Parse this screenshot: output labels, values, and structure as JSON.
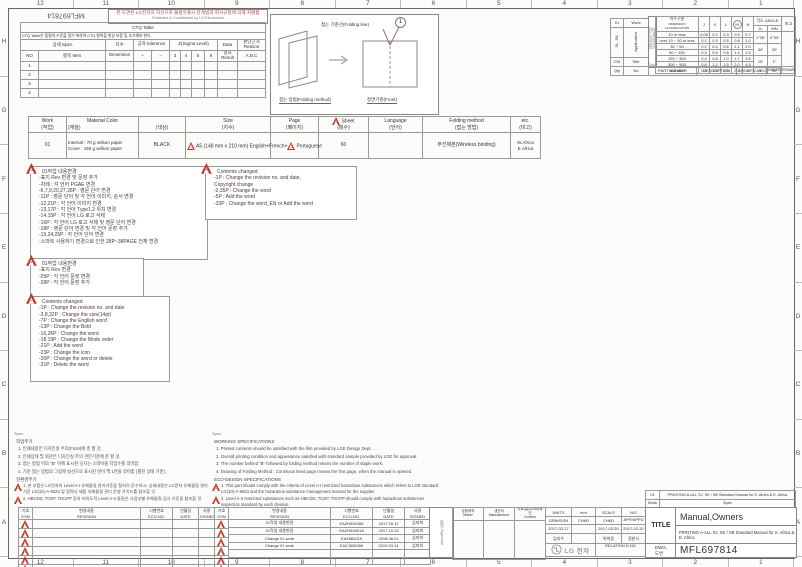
{
  "frame": {
    "ruler_top": [
      "12",
      "11",
      "10",
      "9",
      "8",
      "7",
      "6",
      "5",
      "4",
      "3",
      "2",
      "1"
    ],
    "ruler_bottom": [
      "12",
      "11",
      "10",
      "9",
      "8",
      "7",
      "6",
      "5",
      "4",
      "3",
      "2",
      "1"
    ],
    "ruler_left": [
      "H",
      "G",
      "F",
      "E",
      "D",
      "C",
      "B",
      "A"
    ],
    "ruler_right": [
      "H",
      "G",
      "F",
      "E",
      "D",
      "C",
      "B",
      "A"
    ]
  },
  "header": {
    "doc_number_flipped": "MFL697814",
    "notice_ko": "본 도면은 LG전자의 자산으로 불법유출시 관계법과 회사규정에 의해 처벌됨",
    "notice_en": "Protected & Confidential by LG Electronics"
  },
  "ctq": {
    "title": "CTQ Table",
    "note": "CTQ Table은 품질의 수준을 알기 위하여 CTQ 항목을 항상 보증 및 추가해야 한다.",
    "h_spec": "상세 Spec.",
    "h_no": "NO",
    "h_item": "항목 Item",
    "h_dim": "치수",
    "h_dim2": "Dimension",
    "h_tol": "공차 tolerance",
    "h_plus": "+",
    "h_minus": "−",
    "h_sigma": "Z(Sigma Level)",
    "sigma_levels": [
      "3",
      "4",
      "5",
      "6"
    ],
    "h_data": "Data",
    "h_result": "결과 Result",
    "h_reason": "판단근거 Reason",
    "h_abc": "A,B,C",
    "rows": [
      [
        "1",
        "",
        "",
        "",
        "",
        "",
        "",
        "",
        "",
        "",
        ""
      ],
      [
        "2",
        "",
        "",
        "",
        "",
        "",
        "",
        "",
        "",
        "",
        ""
      ],
      [
        "3",
        "",
        "",
        "",
        "",
        "",
        "",
        "",
        "",
        "",
        ""
      ],
      [
        "4",
        "",
        "",
        "",
        "",
        "",
        "",
        "",
        "",
        "",
        ""
      ]
    ]
  },
  "folding": {
    "line_label": "접는 기준선(Folding line)",
    "marker": "1",
    "method_label": "접는 방법(Folding method)",
    "front_label": "정면기준(Front)"
  },
  "app_table": {
    "rows": [
      [
        "01",
        "Work"
      ],
      [
        "SL, SK",
        "Application"
      ],
      [
        "CW",
        "Site"
      ],
      [
        "Qty",
        "No"
      ]
    ]
  },
  "part_row": [
    "PART NUMBER",
    "DESCRIPTION",
    "SPECIFICATION",
    "MAKER",
    "REMARKER"
  ],
  "tolerance": {
    "side_label": "일반공차(3급) TOLERANCE",
    "side_bottom": "2mm",
    "h_class_ko": "치수구분",
    "h_class_en": "DIMENSION CLASSIFICATION",
    "cols": [
      "J",
      "K",
      "L",
      "M",
      "N"
    ],
    "h_angle": "각도 ANGLE",
    "angle_cols": [
      "JL",
      "MN"
    ],
    "h_remark": "비고",
    "rows": [
      [
        "10 or less",
        "0.05",
        "0.2",
        "0.3",
        "0.5",
        "0.7",
        {
          "t": "1°30′",
          "rs": 2
        },
        {
          "t": "0°30′",
          "rs": 2
        },
        {
          "t": "",
          "rs": 7
        }
      ],
      [
        "over 10 ~ 30 or less",
        "0.1",
        "0.3",
        "0.5",
        "0.8",
        "1.2"
      ],
      [
        "30 ~ 50",
        "0.2",
        "0.4",
        "0.6",
        "1.1",
        "2.0",
        {
          "t": "30′",
          "rs": 2
        },
        {
          "t": "20′",
          "rs": 2
        }
      ],
      [
        "50 ~ 150",
        "0.3",
        "0.6",
        "0.8",
        "1.4",
        "2.5"
      ],
      [
        "150 ~ 300",
        "0.4",
        "0.8",
        "1.0",
        "1.7",
        "3.5",
        {
          "t": "15′",
          "rs": 2
        },
        {
          "t": "1°",
          "rs": 2
        }
      ],
      [
        "300 ~ 500",
        "0.6",
        "1.2",
        "1.5",
        "2.0",
        "4.5"
      ],
      [
        "500 over",
        "0.8",
        "1.6",
        "2.0",
        "2.5",
        "6",
        {
          "t": "5′"
        },
        {
          "t": "30′"
        }
      ]
    ]
  },
  "spec_table": {
    "headers": {
      "work": "Work",
      "work_ko": "(작업)",
      "material": "Material Color",
      "material_ko": "(재질)",
      "color_ko": "(색상)",
      "size": "Size",
      "size_ko": "(치수)",
      "page": "Page",
      "page_ko": "(페이지)",
      "sheet": "Sheet",
      "sheet_ko": "(매수)",
      "sheet_marker": "1",
      "language": "Language",
      "language_ko": "(언어)",
      "folding": "Folding method",
      "folding_ko": "(접는 방법)",
      "etc": "etc.",
      "etc_ko": "(비고)"
    },
    "row": {
      "work": "01",
      "material_line1": "Internal : 70 g vellum paper",
      "material_line2": "Cover : 150 g vellum paper",
      "color": "BLACK",
      "size_marker": "2",
      "size": "A5 (148 mm x 210 mm)",
      "languages_1": "English+French+",
      "languages_marker": "3",
      "languages_2": "Portuguese",
      "page": "",
      "sheet": "60",
      "language": "",
      "folding": "무선제본(Wireless binding)",
      "etc_line1": "W.Africa",
      "etc_line2": "E.Africa"
    }
  },
  "notes": {
    "box1": {
      "marker": "1",
      "title": "01작업 내용변경",
      "lines": [
        "-표지 Rev 변경 및 문장 추가",
        "-차례 : 각 언어 PGAE 변경",
        "-6,7,9,20,27,28P : 영문 단어 변경",
        "-11P : 영문 단어 및 각 언어 이미지, 순서 변경",
        "-12,21P : 각 언어 이미지 변경",
        "-13,17P : 각 언어 Type1,2 위치 변경",
        "-14,15P : 각 언어 LG 로고 삭제",
        "-16P : 각 언어 LG 로고 삭제 및 영문 단어 변경",
        "-18P : 영문 단어 변경 및 각 언어 문장 추가",
        "-19,24,25P : 각 언어 단어 변경",
        "-스마트 사용하기 변경으로 인한 28P~38PAGE 전체 변경"
      ]
    },
    "box2": {
      "marker": "4",
      "title": "Contents changed",
      "lines": [
        "-1P : Change the revision no. and date,",
        "      Copyright change",
        "-2,35P : Change the word",
        "-5P : Add the word",
        "-33P : Change the word_EN or Add the word"
      ]
    },
    "box3": {
      "marker": "2",
      "title": "01작업 내용변경",
      "lines": [
        "-표지 Rev 변경",
        "-25P : 각 언어 문장 변경",
        "-28P : 각 언어 문장 추가"
      ]
    },
    "box4": {
      "marker": "3",
      "title": "Contents changed",
      "lines": [
        "-1P : Change the revision no. and date",
        "-3,8,32P : Change the size(14pt)",
        "-7P : Change the English word",
        "-13P : Change the Bold",
        "-16,26P : Change the word",
        "-18,19P : Change the Mode order",
        "-21P : Add the word",
        "-23P : Change the icon",
        "-30P : Change the word or delete",
        "-31P : Delete the word"
      ]
    }
  },
  "work_spec_ko": {
    "spec_label": "Spec.",
    "heading": "작업주기",
    "lines": [
      "1. 인쇄내용은 디자인실 주의(FILM)에 준 할 것.",
      "2. 인쇄상태 및 외관은 디자인실 주의 견본기준에 준 할 것.",
      "3. 접는 방법 뒤의 \"B\" 뒤에 표시된 숫자는 스테이플 작업수를 의미함.",
      "4. 기준 접는 방법의 그림에 실선으로 표시된 면이 책 1면을 의미함 (펼친 상태 기준)."
    ],
    "eco_heading": "친환경주기",
    "eco_lines": [
      {
        "marker": "2",
        "text": "1. 본 부품은 LG전자의 Level A-I 유해물질 관리기준을 철저히 준수하고, 상세내용은 LG전자 유해물질 관리기준 LG(10)-A-9023 및 협력사 제품 유해물질 관리 운영 가이드를 참조할 것."
      },
      {
        "marker": "4",
        "text": "2. HBCDD, TCEP, TDCPP 등의 비의도적 Level A-II 물질은 사업부별 유해물질 검사 기준을 참조할 것."
      }
    ]
  },
  "work_spec_en": {
    "spec_label": "Spec.",
    "heading": "WORKING SPECIFICATIONS",
    "lines": [
      "1. Printed contents should be satisfied with the film provided by LGE Design Dept.",
      "2. Overall printing condition and appearance satisfied with standard sample provided by LGE for approval.",
      "3. The number behind \"B\" followed by folding method means the number of  staple work.",
      "4. Drawing of Folding Method : Continous lined page means the first page, when  the manual is opened."
    ],
    "eco_heading": "ECO-DESIGN SPECIFICATIONS",
    "eco_lines": [
      {
        "marker": "2",
        "text": "1. This part should comply with the criteria of Level A-I restricted hazardous substances which refers to LGE standard LG(10)-A-9023 and the hazardous substance management manual for the supplier."
      },
      {
        "marker": "4",
        "text": "2. Level A-II restricted substances such as HBCDD, TCEP, TDCPP should comply with hazardous substances inspection standard by each division."
      }
    ]
  },
  "rev_left": {
    "h_sym": "기호\nSYM",
    "h_rev": "변경내용\nREVISION",
    "h_eco": "시행번호\nECO.NO.",
    "h_date": "년월일\nDATE",
    "h_sign": "서명\nSIGNED",
    "rows": [
      [
        {
          "tri": "1"
        },
        "",
        "",
        "",
        "",
        {
          "tri": "1"
        }
      ],
      [
        {
          "tri": "2"
        },
        "",
        "",
        "",
        "",
        {
          "tri": "2"
        }
      ],
      [
        {
          "tri": "3"
        },
        "",
        "",
        "",
        "",
        {
          "tri": "3"
        }
      ],
      [
        {
          "tri": "4"
        },
        "",
        "",
        "",
        "",
        {
          "tri": "4"
        }
      ],
      [
        {
          "tri": "5"
        },
        "",
        "",
        "",
        "",
        {
          "tri": "5"
        }
      ],
      [
        {
          "tri": "6"
        },
        "",
        "",
        "",
        "",
        {
          "tri": "6"
        }
      ]
    ]
  },
  "rev_right": {
    "h_rev": "변경내용\nREVISION",
    "h_eco": "시행번호\nECO.NO.",
    "h_date": "년월일\nDATE",
    "h_sign": "서명\nSIGNED",
    "approval": "협의 Approval",
    "rows": [
      [
        "01작업 내용변경",
        "EAZH600166",
        "2017.09.11",
        "심미희"
      ],
      [
        "01작업 내용변경",
        "EAZHA00018",
        "2017.10.13",
        "심미희"
      ],
      [
        "Change 01 work",
        "EAZ660219",
        "2018.06.21",
        "심미희"
      ],
      [
        "Change 01 work",
        "EAZJ505286",
        "2019.03.14",
        "심미희"
      ],
      [
        "",
        "",
        "",
        ""
      ],
      [
        "",
        "",
        "",
        ""
      ]
    ]
  },
  "title_block": {
    "maker_label": "금형제작\nMaker",
    "manufacturer_label": "생산처\nManufacturer",
    "confirm_label": "자료실(2D/3D)확인\nConfirm",
    "work_no": "01",
    "work_label": "Work",
    "spec_text": "PRINTING A-ALL SJ, SK / SB Standard Manual for S. Africa & E. Africa",
    "spec_label": "Spec",
    "units_label": "UNITS",
    "units_value": "mm",
    "scale_label": "SCALE",
    "scale_value": "N/S",
    "drw_label": "DRW/DSN",
    "chkd_label": "CHKD",
    "chkd2_label": "CHKD",
    "app_label": "APP/APPD",
    "drw_date": "2017-02-17",
    "chkd2_date": "2017-02-20",
    "app_date": "2017-02-20",
    "drw_name": "김지수",
    "chkd2_name": "박희웅",
    "app_name": "정완식",
    "logo_text": "LG 전자",
    "relation_label": "RELATION D.NO",
    "title_label": "TITLE",
    "title_value": "Manual,Owners",
    "subtitle": "PRINTING A-ALL SJ, SK / SB Standard Manual for S. Africa & E. Africa",
    "dwg_label": "DWG,\n도번",
    "dwg_value": "MFL697814"
  }
}
